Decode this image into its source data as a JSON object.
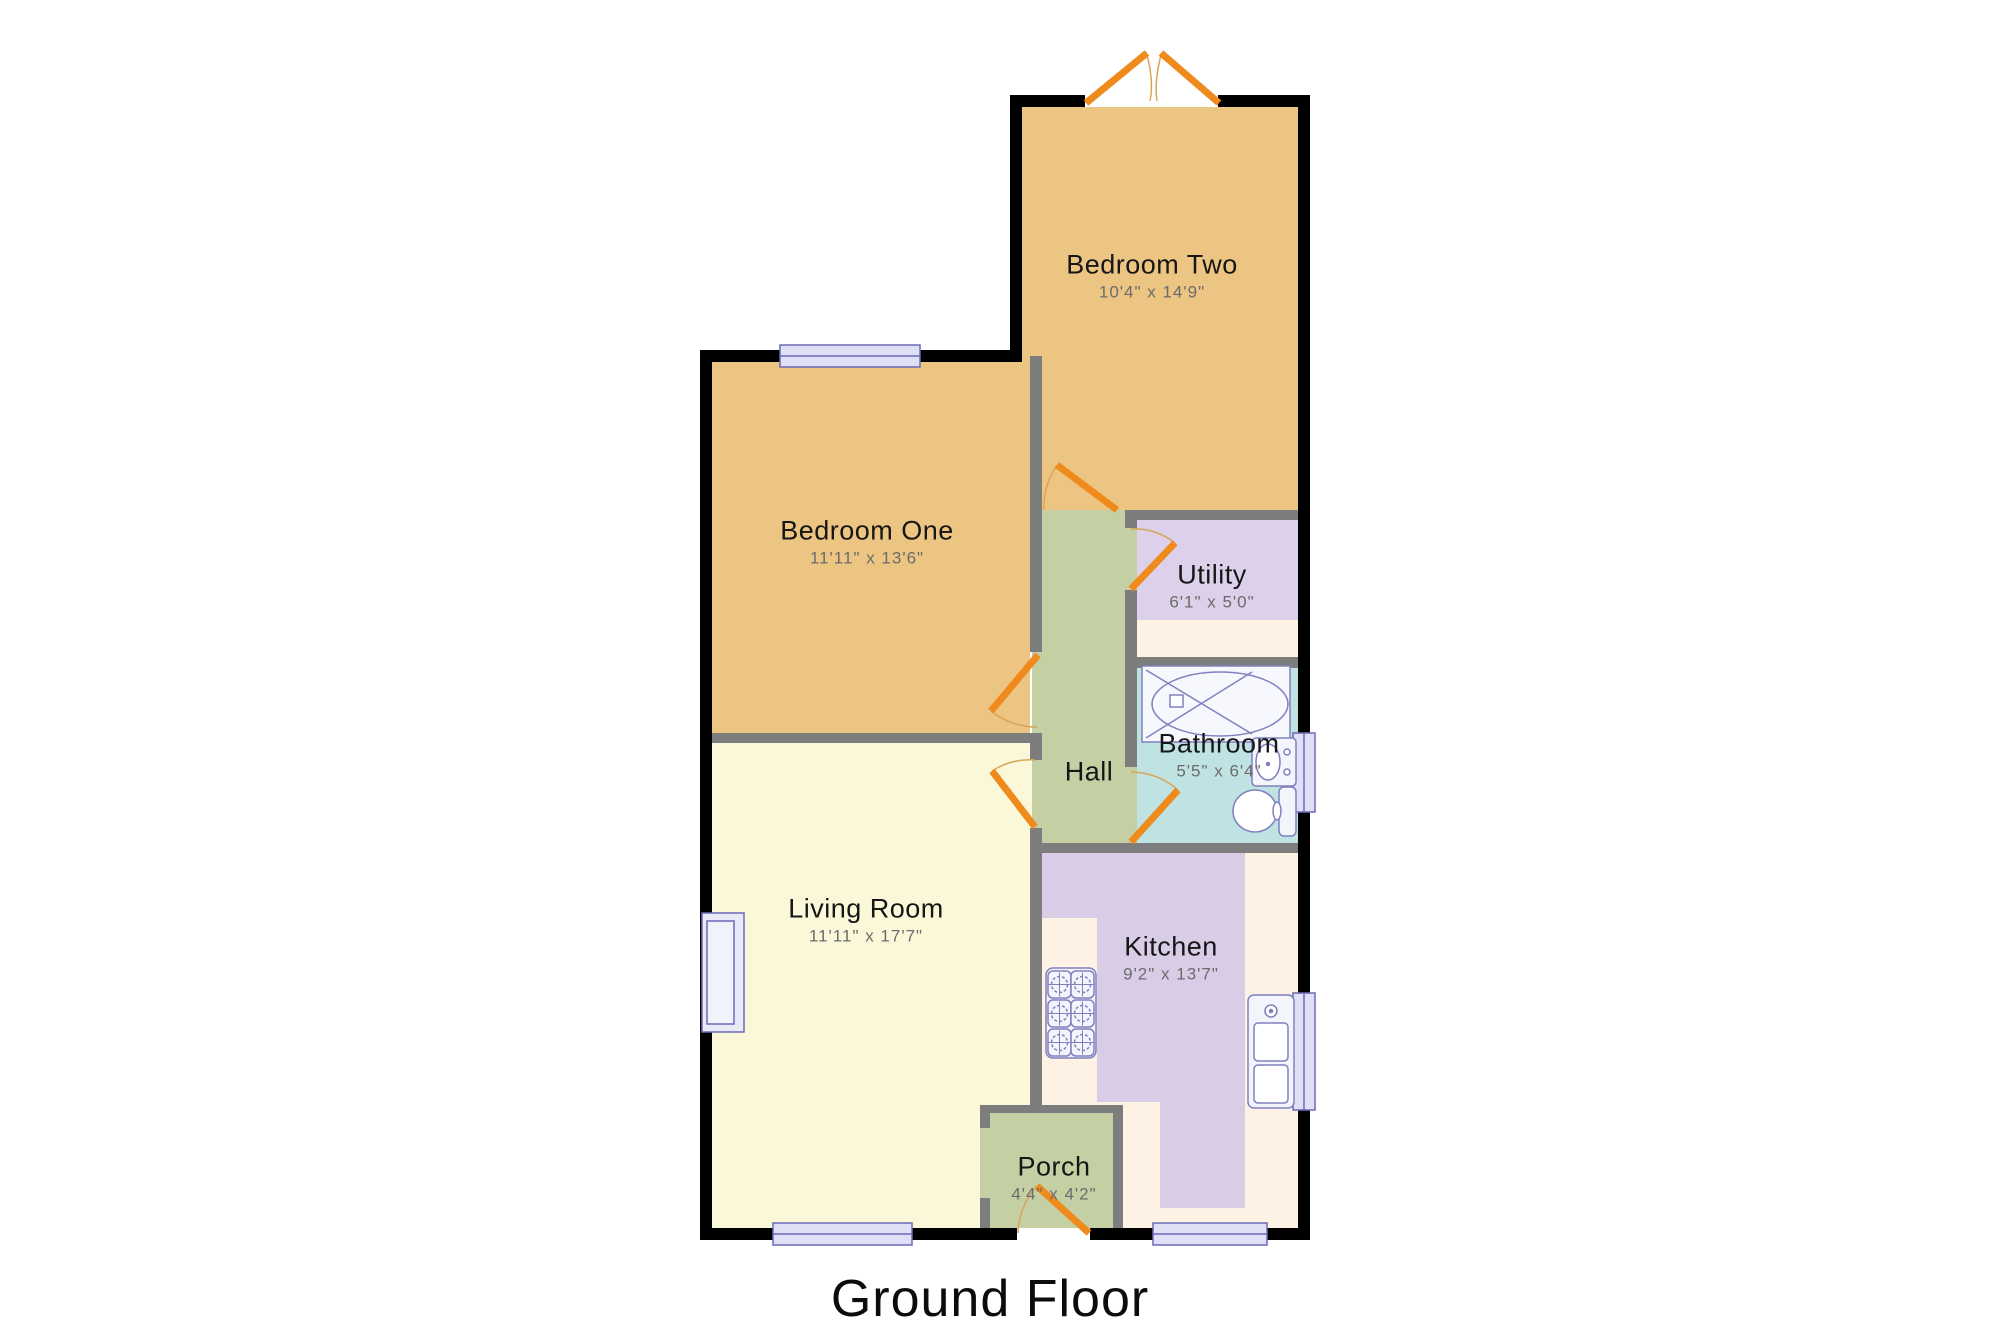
{
  "title": "Ground Floor",
  "rooms": {
    "bedroom_two": {
      "name": "Bedroom Two",
      "dims": "10'4\" x 14'9\""
    },
    "bedroom_one": {
      "name": "Bedroom One",
      "dims": "11'11\" x 13'6\""
    },
    "utility": {
      "name": "Utility",
      "dims": "6'1\" x 5'0\""
    },
    "bathroom": {
      "name": "Bathroom",
      "dims": "5'5\" x 6'4\""
    },
    "hall": {
      "name": "Hall"
    },
    "living_room": {
      "name": "Living Room",
      "dims": "11'11\" x 17'7\""
    },
    "kitchen": {
      "name": "Kitchen",
      "dims": "9'2\" x 13'7\""
    },
    "porch": {
      "name": "Porch",
      "dims": "4'4\" x 4'2\""
    }
  },
  "colors": {
    "wall_outer": "#000000",
    "wall_inner": "#7d7d7d",
    "bedroom": "#edc583",
    "hall": "#c5cfa4",
    "living_room": "#fbf8da",
    "utility": "#ddd0ea",
    "kitchen": "#d9cce6",
    "kitchen_floor": "#fdf2e3",
    "bathroom": "#bfe3e2",
    "porch": "#c5cfa4",
    "door": "#ef8a1d",
    "door_arc": "#d8a558",
    "window_fill": "#dfdff5",
    "window_border": "#6a6ab8",
    "fixture_border": "#8080bf",
    "fixture_fill": "#f4f4fc"
  }
}
